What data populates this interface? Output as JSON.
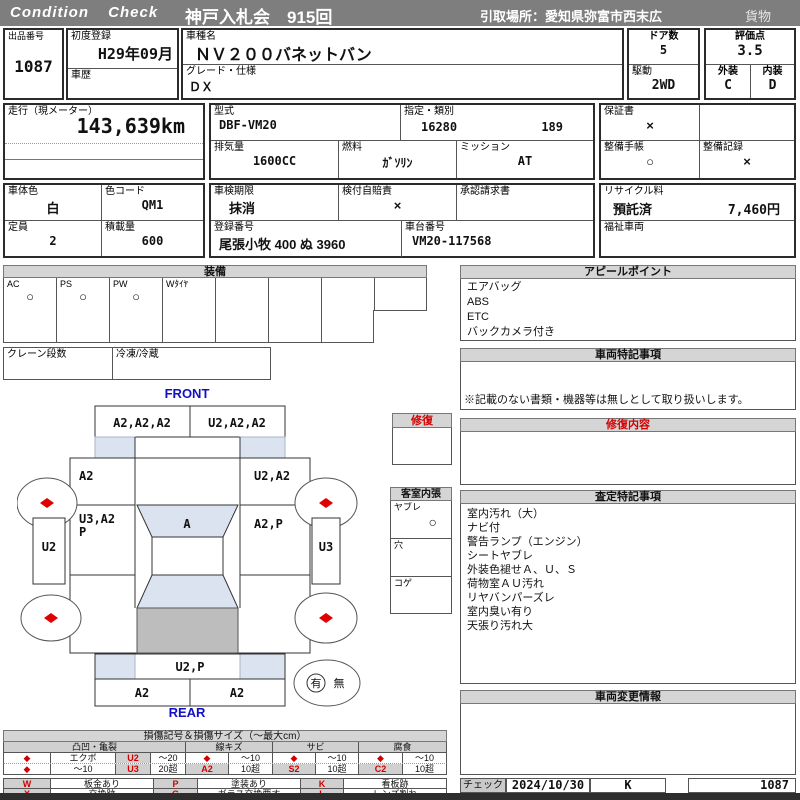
{
  "header": {
    "brand": "Condition Check",
    "title": "神戸入札会　915回",
    "pickup_location": "引取場所：愛知県弥富市西末広",
    "category": "貨物"
  },
  "info": {
    "lot_no": {
      "label": "出品番号",
      "value": "1087"
    },
    "first_registration": {
      "label": "初度登録",
      "value": "H29年09月"
    },
    "history": {
      "label": "車歴",
      "value": ""
    },
    "model_name": {
      "label": "車種名",
      "value": "ＮＶ２００バネットバン"
    },
    "grade": {
      "label": "グレード・仕様",
      "value": "ＤＸ"
    },
    "doors": {
      "label": "ドア数",
      "value": "5"
    },
    "drive": {
      "label": "駆動",
      "value": "2WD"
    },
    "score": {
      "label": "評価点",
      "value": "3.5"
    },
    "exterior": {
      "label": "外装",
      "value": "C"
    },
    "interior": {
      "label": "内装",
      "value": "D"
    },
    "mileage": {
      "label": "走行（現メーター）",
      "value": "143,639km"
    },
    "model_code": {
      "label": "型式",
      "value": "DBF-VM20"
    },
    "type_class": {
      "label": "指定・類別",
      "type": "16280",
      "class": "189"
    },
    "warranty": {
      "label": "保証書",
      "value": "×"
    },
    "displacement": {
      "label": "排気量",
      "value": "1600CC"
    },
    "fuel": {
      "label": "燃料",
      "value": "ｶﾞｿﾘﾝ"
    },
    "transmission": {
      "label": "ミッション",
      "value": "AT"
    },
    "maintenance_book": {
      "label": "整備手帳",
      "value": "○"
    },
    "maintenance_record": {
      "label": "整備記録",
      "value": "×"
    },
    "body_color": {
      "label": "車体色",
      "value": "白"
    },
    "color_code": {
      "label": "色コード",
      "value": "QM1"
    },
    "inspection_expiry": {
      "label": "車検期限",
      "value": "抹消"
    },
    "insurance": {
      "label": "検付自賠責",
      "value": "×"
    },
    "approval_request": {
      "label": "承認請求書",
      "value": ""
    },
    "recycle": {
      "label": "リサイクル料",
      "status": "預託済",
      "fee": "7,460円"
    },
    "capacity": {
      "label": "定員",
      "value": "2"
    },
    "load": {
      "label": "積載量",
      "value": "600"
    },
    "registration_no": {
      "label": "登録番号",
      "value": "尾張小牧 400 ぬ  3960"
    },
    "chassis_no": {
      "label": "車台番号",
      "value": "VM20-117568"
    },
    "welfare": {
      "label": "福祉車両",
      "value": ""
    }
  },
  "equipment": {
    "title": "装備",
    "items": [
      {
        "label": "AC",
        "mark": "○"
      },
      {
        "label": "PS",
        "mark": "○"
      },
      {
        "label": "PW",
        "mark": "○"
      },
      {
        "label": "Wﾀｲﾔ",
        "mark": ""
      }
    ],
    "crane_label": "クレーン段数",
    "reefer_label": "冷凍/冷蔵"
  },
  "diagram": {
    "front_label": "FRONT",
    "rear_label": "REAR",
    "front_panel_left": "A2,A2,A2",
    "front_panel_right": "U2,A2,A2",
    "left_fender": "A2",
    "right_fender": "U2,A2",
    "left_door_1": "U3,A2",
    "left_door_2": "P",
    "windshield": "A",
    "right_door": "A2,P",
    "left_sill": "U2",
    "right_sill": "U3",
    "rear_gate": "U2,P",
    "rear_panel_left": "A2",
    "rear_panel_right": "A2",
    "presence_yes": "有",
    "presence_no": "無"
  },
  "repair_box": {
    "title": "修復"
  },
  "interior_box": {
    "title": "客室内張",
    "rows": [
      {
        "label": "ヤブレ",
        "mark": "○"
      },
      {
        "label": "穴",
        "mark": ""
      },
      {
        "label": "コゲ",
        "mark": ""
      }
    ]
  },
  "right_column": {
    "appeal": {
      "title": "アピールポイント",
      "items": [
        "エアバッグ",
        "ABS",
        "ETC",
        "バックカメラ付き"
      ]
    },
    "vehicle_notes": {
      "title": "車両特記事項",
      "note": "※記載のない書類・機器等は無しとして取り扱いします。"
    },
    "repair_details": {
      "title": "修復内容"
    },
    "assessment_notes": {
      "title": "査定特記事項",
      "items": [
        "室内汚れ（大）",
        "ナビ付",
        "警告ランプ（エンジン）",
        "シートヤブレ",
        "外装色褪せＡ、Ｕ、Ｓ",
        "荷物室ＡＵ汚れ",
        "リヤバンパーズレ",
        "室内臭い有り",
        "天張り汚れ大"
      ]
    },
    "change_info": {
      "title": "車両変更情報"
    },
    "check": {
      "label": "チェック",
      "date": "2024/10/30",
      "inspector": "K",
      "lot_no": "1087"
    }
  },
  "legend": {
    "title": "損傷記号＆損傷サイズ（～最大cm）",
    "diamond": "◆",
    "dent": {
      "header": "凸凹・亀裂",
      "r1_name": "エクボ",
      "r1_code": "U2",
      "r1_size": "～20",
      "r2_name": "～10",
      "r2_code": "U3",
      "r2_size": "20超"
    },
    "scratch": {
      "header": "線キズ",
      "r1_size": "～10",
      "code": "A2",
      "r2_size": "10超"
    },
    "rust": {
      "header": "サビ",
      "r1_size": "～10",
      "code": "S2",
      "r2_size": "10超"
    },
    "corrosion": {
      "header": "腐食",
      "r1_size": "～10",
      "code": "C2",
      "r2_size": "10超"
    },
    "symbols": [
      {
        "code": "W",
        "desc": "板金あり"
      },
      {
        "code": "X",
        "desc": "交換跡"
      },
      {
        "code": "P",
        "desc": "塗装あり"
      },
      {
        "code": "G",
        "desc": "ガラス交換要す"
      },
      {
        "code": "K",
        "desc": "看板跡"
      },
      {
        "code": "L",
        "desc": "レンズ割れ"
      }
    ]
  }
}
